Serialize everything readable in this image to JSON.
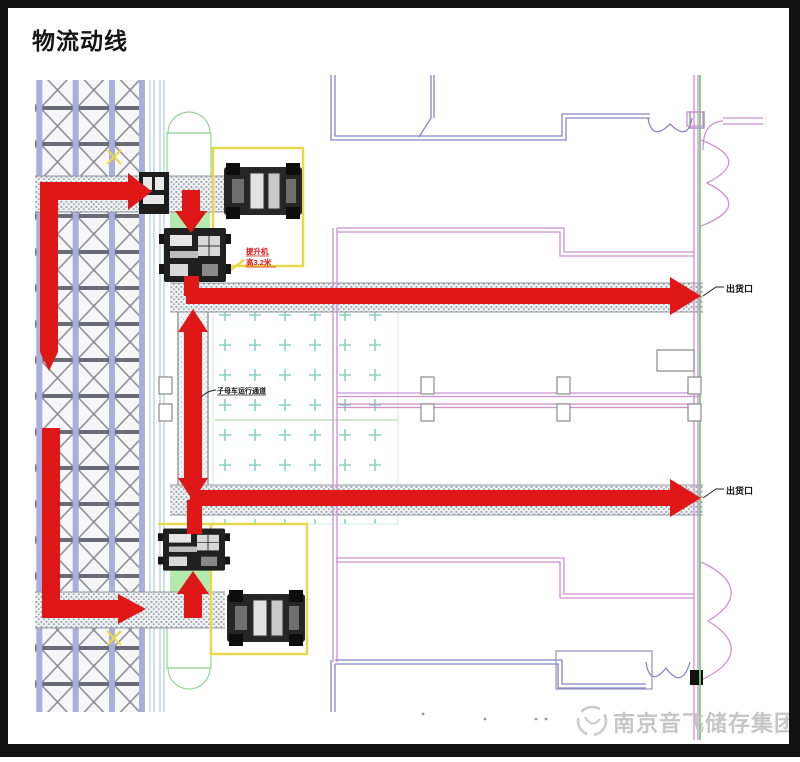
{
  "header": {
    "title": "物流动线"
  },
  "annotations": {
    "outlet_top": "出货口",
    "outlet_bottom": "出货口",
    "lift_note_line1": "提升机",
    "lift_note_line2": "高3.2米",
    "shuttle_note": "子母车运行通道"
  },
  "watermark": {
    "text": "南京音飞储存集团",
    "logo": "swirl-logo-icon"
  },
  "colors": {
    "red": "#df1717",
    "yellow": "#e8d94a",
    "pink": "#cf90cf",
    "wallblue": "#8787c2",
    "green": "#7cc87c",
    "lightgreen": "#b5eaae",
    "teal": "#8ad2c2",
    "rackpurple": "#a9aedd",
    "rackline": "#8c8c99",
    "hatchgray": "#9aa2ab"
  }
}
